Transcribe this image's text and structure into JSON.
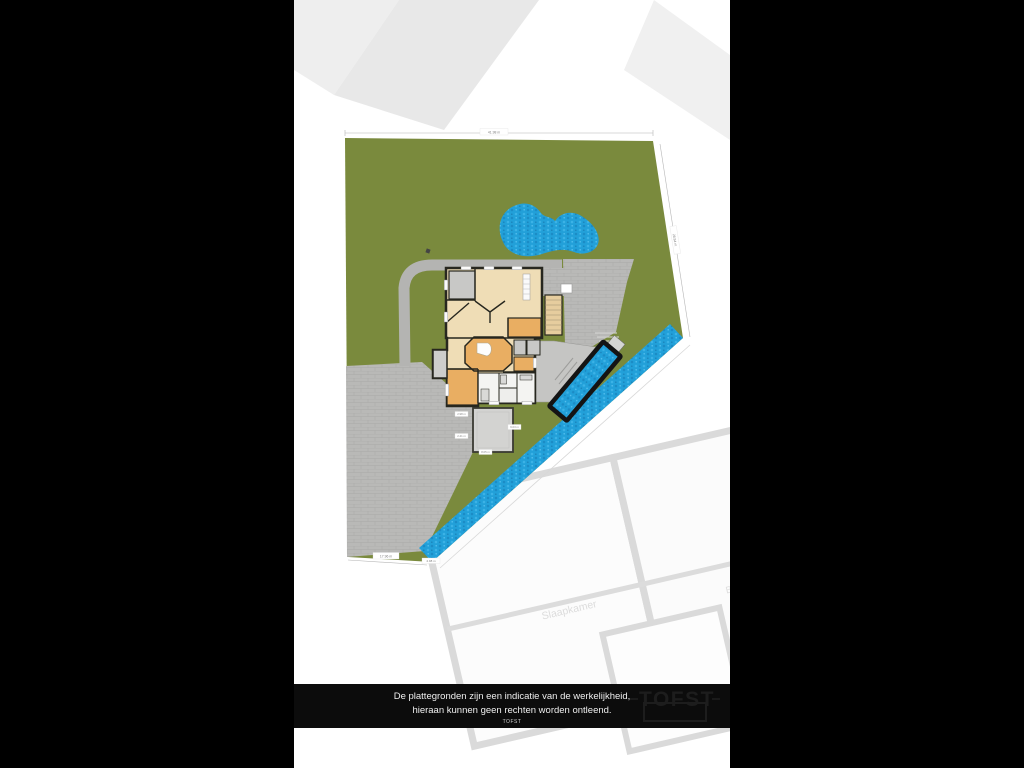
{
  "disclaimer": {
    "line1": "De plattegronden zijn een indicatie van de werkelijkheid,",
    "line2": "hieraan kunnen geen rechten worden ontleend.",
    "line3": "TOFST"
  },
  "logo": {
    "text": "TOFST"
  },
  "site": {
    "dims": {
      "top": "41.98 m",
      "right": "28.84 m",
      "bottom": "17.96 m",
      "canal": "4.98 m"
    },
    "tags": {
      "a": "2.98 m",
      "b": "2.41 m",
      "c": "6.03 m",
      "d": "8.05 m"
    },
    "colors": {
      "grass": "#7a8a3d",
      "water": "#22a0d9",
      "paving": "#b9b9b7",
      "house_tan": "#efddb6",
      "house_orange": "#e9ae62",
      "wall": "#27271f",
      "bar": "#0c0c0c"
    }
  },
  "watermark": {
    "room1": "Slaapkamer",
    "room2": "Berging"
  }
}
